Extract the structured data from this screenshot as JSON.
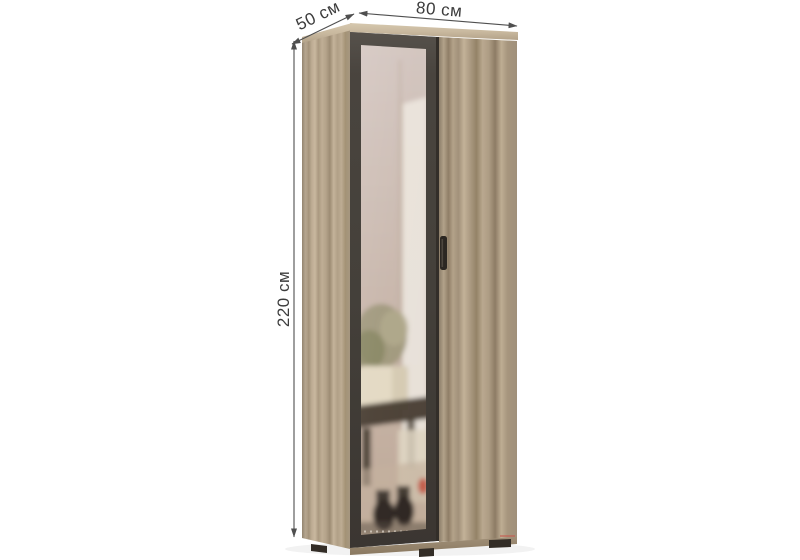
{
  "page": {
    "background": "#ffffff",
    "description": "Product render of a two-door wardrobe with a framed mirror door and measurement arrows"
  },
  "dimensions": {
    "depth": "50 см",
    "width": "80 см",
    "height": "220 см"
  },
  "colors": {
    "wood_base": "#b2a189",
    "wood_light": "#cdbda4",
    "wood_dark": "#8f7e66",
    "door_frame": "#46413b",
    "door_gap": "#332e29",
    "mirror_tint": "#c9b8ae",
    "handle": "#2c2722",
    "feet": "#332d27",
    "annotation_line": "#4f4f4f",
    "annotation_text": "#3c3c3c",
    "reflection_accent": "#c14b3a"
  }
}
